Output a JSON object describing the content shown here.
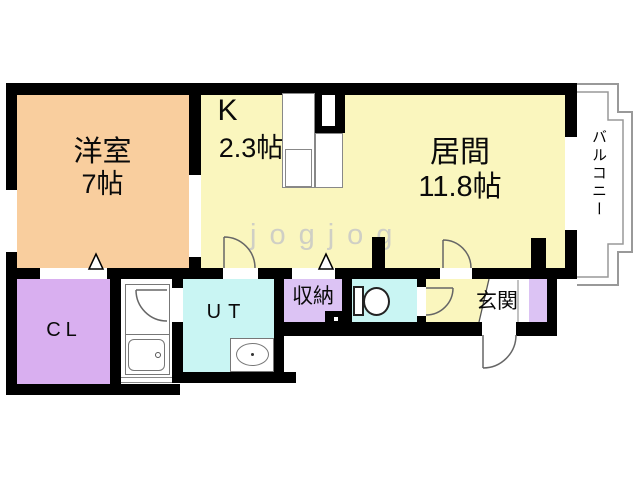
{
  "floorplan": {
    "watermark": "jogjog",
    "rooms": {
      "western_room": {
        "name": "洋室",
        "size": "7帖"
      },
      "kitchen": {
        "name": "K",
        "size": "2.3帖"
      },
      "living_room": {
        "name": "居間",
        "size": "11.8帖"
      },
      "balcony": {
        "name": "バルコニー"
      },
      "closet": {
        "name": "CL"
      },
      "utility": {
        "name": "UT"
      },
      "storage": {
        "name": "収納"
      },
      "entrance": {
        "name": "玄関"
      }
    },
    "colors": {
      "wall": "#000000",
      "western_room_floor": "#f9ce9e",
      "living_kitchen_floor": "#faf6be",
      "closet_floor": "#d9aff0",
      "storage_floor": "#dcc3f4",
      "utility_toilet_floor": "#c9f5f3",
      "balcony_outline": "#999999",
      "watermark_gray": "#cfcfc5"
    }
  }
}
